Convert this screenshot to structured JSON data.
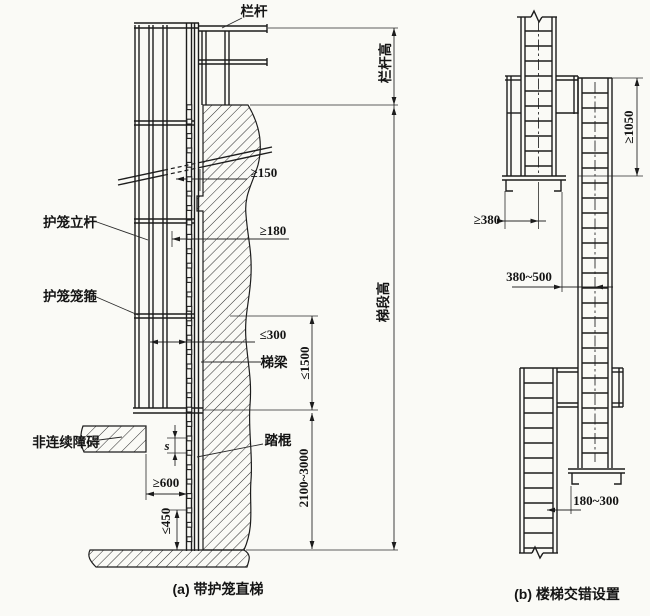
{
  "figure": {
    "caption_a": "(a) 带护笼直梯",
    "caption_b": "(b) 楼梯交错设置"
  },
  "diagram_a": {
    "labels": {
      "guardrail": "栏杆",
      "cage_upright": "护笼立杆",
      "cage_hoop": "护笼笼箍",
      "discontinuous_obstacle": "非连续障碍",
      "stringer": "梯梁",
      "rung": "踏棍"
    },
    "dims": {
      "ge150": "≥150",
      "ge180": "≥180",
      "le300": "≤300",
      "le1500": "≤1500",
      "s": "s",
      "ge600": "≥600",
      "le450": "≤450",
      "r2100_3000": "2100~3000",
      "guardrail_height": "栏杆高",
      "flight_height": "梯段高"
    }
  },
  "diagram_b": {
    "dims": {
      "ge1050": "≥1050",
      "ge380": "≥380",
      "r380_500": "380~500",
      "r180_300": "180~300"
    }
  }
}
